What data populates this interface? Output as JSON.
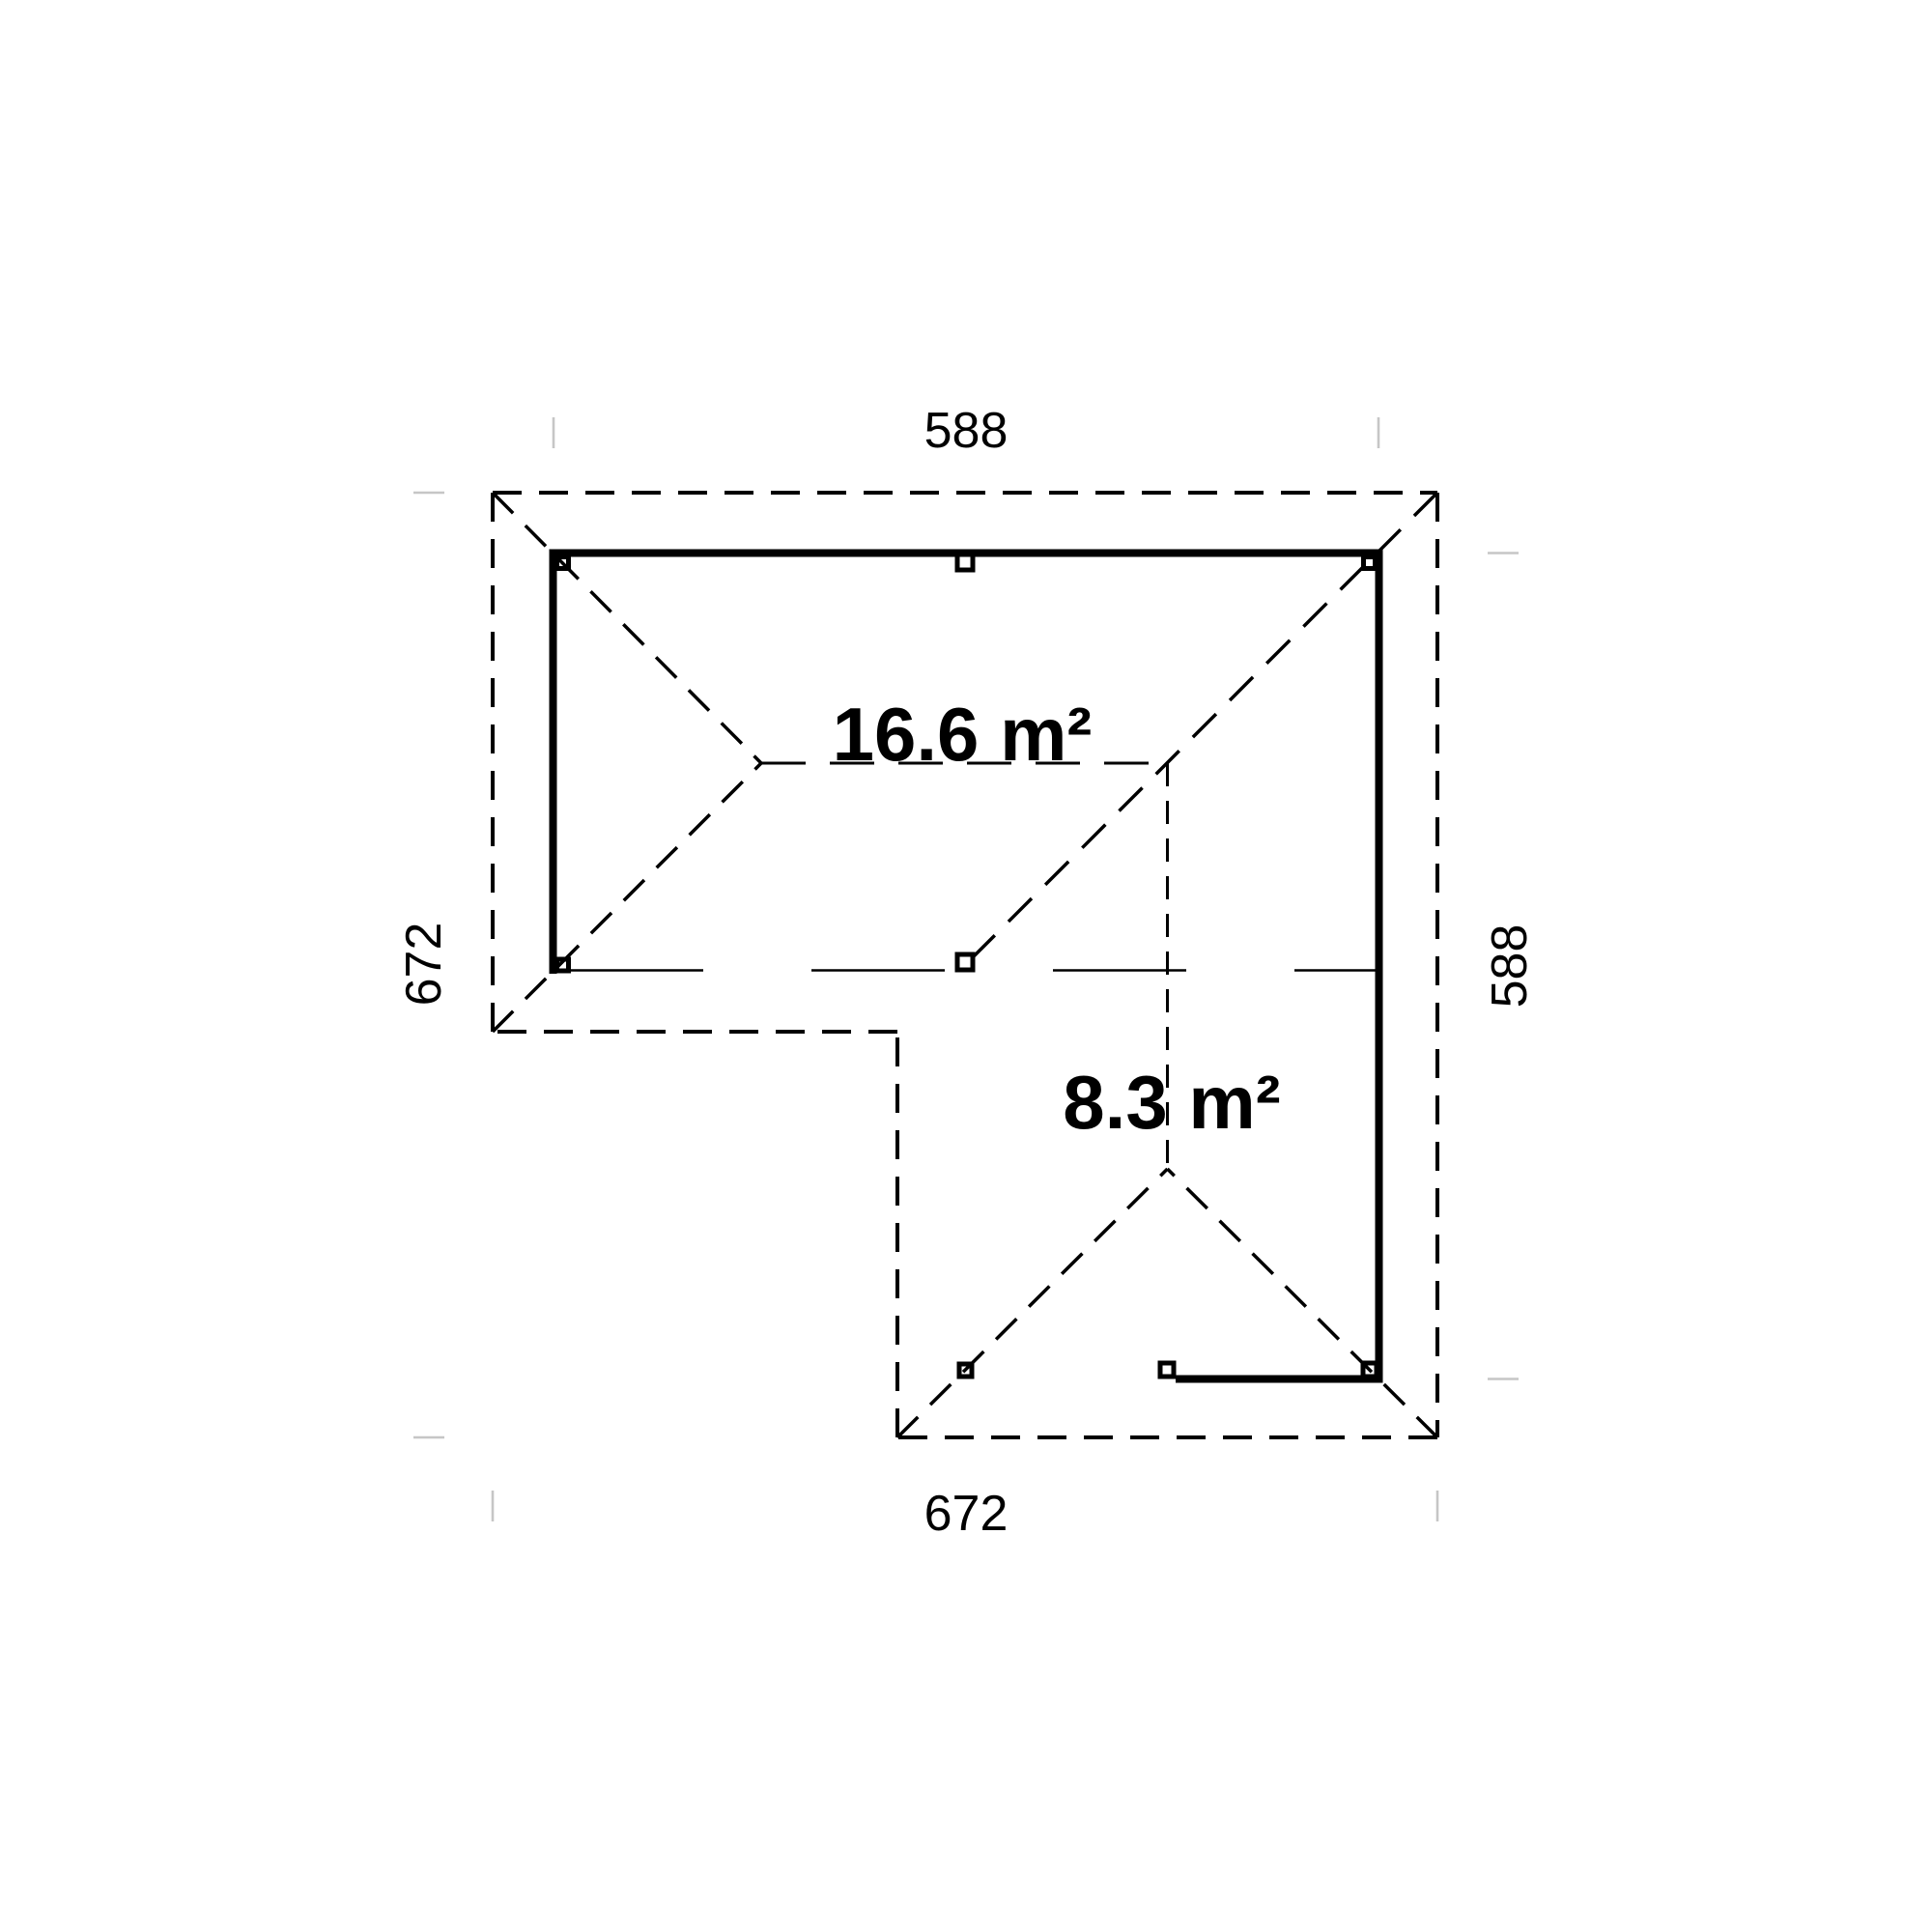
{
  "drawing": {
    "kind": "floor-plan",
    "dimension_labels": {
      "top": "588",
      "right": "588",
      "left": "672",
      "bottom": "672"
    },
    "area_labels": {
      "main_room": "16.6 m²",
      "annex": "8.3 m²"
    },
    "colors": {
      "line": "#000000",
      "background": "#ffffff",
      "witness_tick": "#c6c6c6"
    }
  }
}
